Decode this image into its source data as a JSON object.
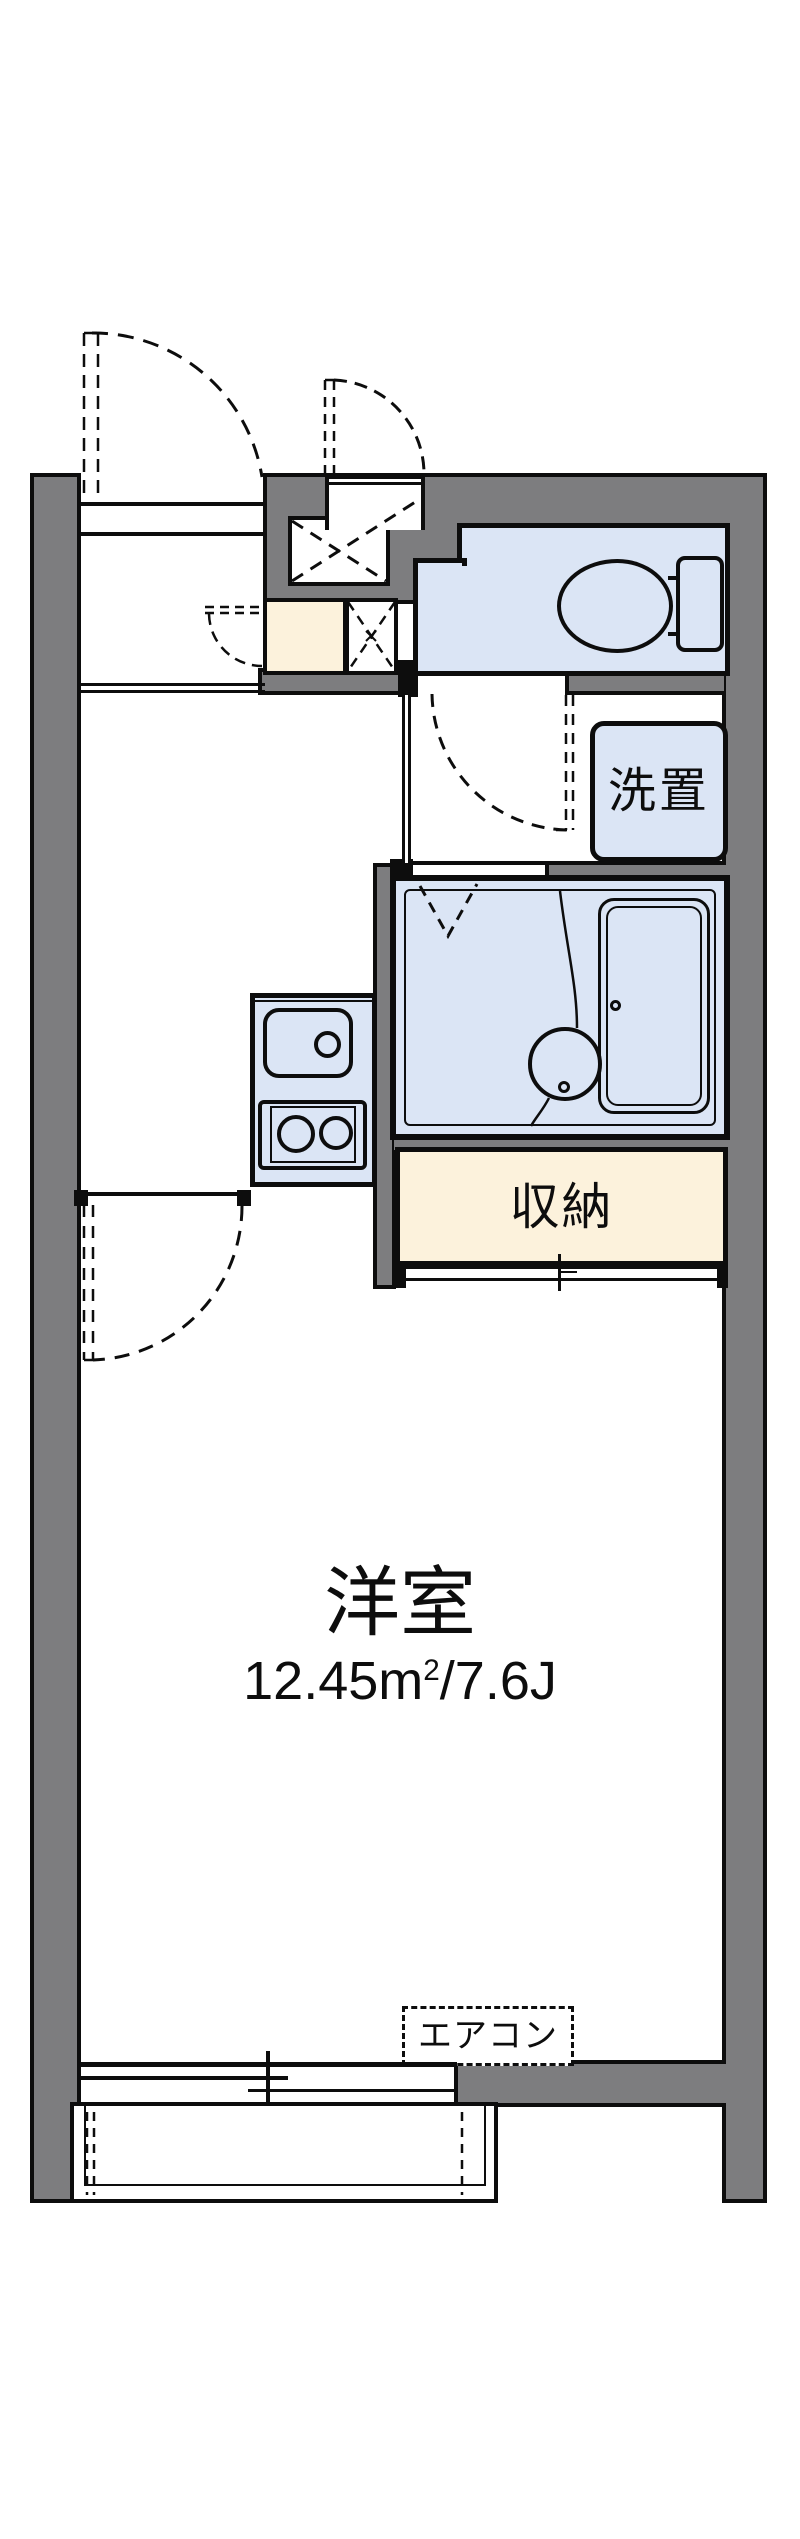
{
  "document": {
    "type": "apartment-floorplan"
  },
  "colors": {
    "wall_fill": "#7d7d7f",
    "outline": "#0d0d0d",
    "wet_area_blue": "#dbe5f5",
    "storage_cream": "#fcf2dc",
    "background": "#ffffff"
  },
  "rooms": {
    "main": {
      "label": "洋室",
      "area_text": "12.45㎡/7.6J",
      "area_value": "12.45m",
      "area_sup": "2",
      "area_suffix": "/7.6J"
    },
    "closet": {
      "label": "収納"
    },
    "laundry": {
      "label": "洗置"
    },
    "aircon": {
      "label": "エアコン"
    }
  },
  "fixtures": [
    "entrance-door-swing",
    "meter-box-door-swing",
    "meter-box-x",
    "pipe-space-x",
    "shoe-cabinet",
    "toilet-bowl",
    "toilet-tank",
    "washroom-door-swing",
    "washing-machine-space",
    "unit-bath",
    "bathtub",
    "wash-basin",
    "shower-divider",
    "bath-folding-door",
    "kitchen-sink",
    "kitchen-faucet",
    "gas-stove",
    "room-door-swing",
    "closet-sliding-door",
    "sliding-window",
    "balcony",
    "air-conditioner-box"
  ]
}
